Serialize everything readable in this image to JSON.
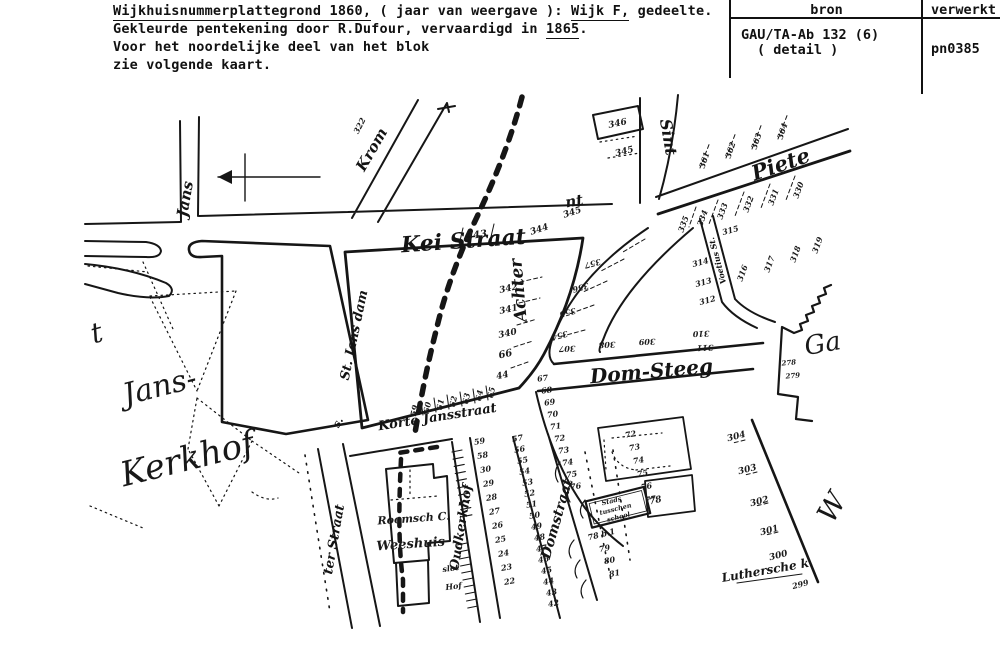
{
  "header": {
    "l1a": "Wijkhuisnummerplattegrond 1860,",
    "l1b": " ( jaar van weergave ): ",
    "l1c": "Wijk F,",
    "l1d": " gedeelte.",
    "l2a": "Gekleurde pentekening door R.Dufour, vervaardigd in ",
    "l2b": "1865",
    "l2c": ".",
    "l3": "Voor het noordelijke deel van het blok",
    "l4": "zie volgende kaart."
  },
  "table": {
    "col1_header": "bron",
    "col2_header": "verwerkt",
    "source_line1": "GAU/TA-Ab 132 (6)",
    "source_line2": "( detail )",
    "processed": "pn0385"
  },
  "map": {
    "ink": "#161616",
    "script_labels": [
      {
        "t": "t",
        "x": 99,
        "y": 342,
        "r": -15,
        "s": 28,
        "n": "script-janskerkhof-partial"
      },
      {
        "t": "Jans-",
        "x": 162,
        "y": 396,
        "r": -14,
        "s": 30,
        "n": "script-janskerkhof-jans"
      },
      {
        "t": "Kerkhof",
        "x": 190,
        "y": 470,
        "r": -14,
        "s": 34,
        "n": "script-janskerkhof-kerkhof"
      },
      {
        "t": "Ga",
        "x": 824,
        "y": 352,
        "r": -10,
        "s": 26,
        "n": "script-partial-right"
      },
      {
        "t": "W",
        "x": 840,
        "y": 512,
        "r": -60,
        "s": 28,
        "n": "script-partial-right-lower"
      }
    ],
    "street_labels": [
      {
        "t": "Jans",
        "x": 190,
        "y": 200,
        "r": -80,
        "s": 15,
        "n": "street-label-jans"
      },
      {
        "t": "Krom",
        "x": 376,
        "y": 152,
        "r": -60,
        "s": 15,
        "n": "street-label-krom"
      },
      {
        "t": "Kei Straat",
        "x": 464,
        "y": 248,
        "r": -4,
        "s": 22,
        "n": "street-label-kei-straat"
      },
      {
        "t": "St. Jans dam",
        "x": 358,
        "y": 336,
        "r": -78,
        "s": 13,
        "n": "street-label-st-jans-dam"
      },
      {
        "t": "Sint",
        "x": 663,
        "y": 138,
        "r": 80,
        "s": 16,
        "n": "street-label-sint-north"
      },
      {
        "t": "nt",
        "x": 575,
        "y": 206,
        "r": -10,
        "s": 15,
        "n": "street-label-sint-diagonal"
      },
      {
        "t": "Piete",
        "x": 783,
        "y": 171,
        "r": -19,
        "s": 21,
        "n": "street-label-pieter"
      },
      {
        "t": "Achter",
        "x": 524,
        "y": 290,
        "r": -95,
        "s": 17,
        "n": "street-label-achter"
      },
      {
        "t": "Dom-Steeg",
        "x": 652,
        "y": 378,
        "r": -5,
        "s": 20,
        "n": "street-label-dom-steeg"
      },
      {
        "t": "Voetius St.",
        "x": 720,
        "y": 260,
        "r": -105,
        "s": 8,
        "n": "street-label-voetius-steeg"
      },
      {
        "t": "Korte Jansstraat",
        "x": 438,
        "y": 421,
        "r": -9,
        "s": 13,
        "n": "street-label-korte-jansstraat"
      },
      {
        "t": "ter Straat",
        "x": 338,
        "y": 540,
        "r": -80,
        "s": 13,
        "n": "street-label-ter-straat"
      },
      {
        "t": "Oudkerkhof",
        "x": 465,
        "y": 528,
        "r": -81,
        "s": 13,
        "n": "street-label-oudkerkhof"
      },
      {
        "t": "Domstraat",
        "x": 561,
        "y": 520,
        "r": -74,
        "s": 14,
        "n": "street-label-domstraat"
      },
      {
        "t": "Luthersche k.",
        "x": 768,
        "y": 574,
        "r": -10,
        "s": 12,
        "n": "street-label-luthersche-kerk"
      },
      {
        "t": "s.",
        "x": 341,
        "y": 424,
        "r": -60,
        "s": 11,
        "n": "street-label-fragment"
      }
    ],
    "building_labels": [
      {
        "t": "Roomsch C.",
        "x": 414,
        "y": 522,
        "r": -4,
        "s": 11,
        "n": "building-label-roomsch-c"
      },
      {
        "t": "Weeshuis",
        "x": 411,
        "y": 548,
        "r": -4,
        "s": 13,
        "n": "building-label-weeshuis"
      },
      {
        "t": "Stads",
        "x": 612,
        "y": 503,
        "r": -14,
        "s": 6.5,
        "n": "building-label-stads"
      },
      {
        "t": "tusschen",
        "x": 616,
        "y": 511,
        "r": -14,
        "s": 6.5,
        "n": "building-label-tusschen"
      },
      {
        "t": "school",
        "x": 619,
        "y": 519,
        "r": -14,
        "s": 6.5,
        "n": "building-label-school"
      },
      {
        "t": "slot",
        "x": 451,
        "y": 571,
        "r": -8,
        "s": 8,
        "n": "building-label-slot"
      },
      {
        "t": "Hof",
        "x": 454,
        "y": 589,
        "r": -8,
        "s": 8,
        "n": "building-label-hof"
      },
      {
        "t": "78 b.1",
        "x": 602,
        "y": 537,
        "r": -14,
        "s": 8,
        "n": "building-label-78b1"
      }
    ],
    "numbers": [
      {
        "t": "322",
        "x": 362,
        "y": 127,
        "r": -62,
        "s": 8
      },
      {
        "t": "343",
        "x": 477,
        "y": 238,
        "r": -8,
        "s": 10
      },
      {
        "t": "344",
        "x": 540,
        "y": 232,
        "r": -18,
        "s": 9
      },
      {
        "t": "345",
        "x": 573,
        "y": 215,
        "r": -18,
        "s": 9
      },
      {
        "t": "345",
        "x": 625,
        "y": 154,
        "r": -14,
        "s": 9
      },
      {
        "t": "346",
        "x": 618,
        "y": 126,
        "r": -12,
        "s": 9
      },
      {
        "t": "342",
        "x": 509,
        "y": 291,
        "r": -12,
        "s": 9
      },
      {
        "t": "341",
        "x": 509,
        "y": 312,
        "r": -12,
        "s": 9
      },
      {
        "t": "340",
        "x": 508,
        "y": 336,
        "r": -12,
        "s": 9
      },
      {
        "t": "66",
        "x": 506,
        "y": 357,
        "r": -12,
        "s": 10
      },
      {
        "t": "44",
        "x": 503,
        "y": 378,
        "r": -12,
        "s": 9
      },
      {
        "t": "59",
        "x": 417,
        "y": 411,
        "r": -78,
        "s": 8
      },
      {
        "t": "60",
        "x": 430,
        "y": 408,
        "r": -78,
        "s": 8
      },
      {
        "t": "61",
        "x": 443,
        "y": 405,
        "r": -78,
        "s": 8
      },
      {
        "t": "62",
        "x": 456,
        "y": 402,
        "r": -78,
        "s": 8
      },
      {
        "t": "63",
        "x": 469,
        "y": 399,
        "r": -78,
        "s": 8
      },
      {
        "t": "64",
        "x": 482,
        "y": 396,
        "r": -78,
        "s": 8
      },
      {
        "t": "65",
        "x": 494,
        "y": 393,
        "r": -78,
        "s": 8
      },
      {
        "t": "361",
        "x": 707,
        "y": 161,
        "r": -72,
        "s": 8
      },
      {
        "t": "362",
        "x": 733,
        "y": 151,
        "r": -72,
        "s": 8
      },
      {
        "t": "363",
        "x": 759,
        "y": 142,
        "r": -72,
        "s": 8
      },
      {
        "t": "364",
        "x": 785,
        "y": 132,
        "r": -72,
        "s": 8
      },
      {
        "t": "330",
        "x": 801,
        "y": 191,
        "r": -70,
        "s": 8
      },
      {
        "t": "331",
        "x": 776,
        "y": 198,
        "r": -70,
        "s": 8
      },
      {
        "t": "332",
        "x": 751,
        "y": 205,
        "r": -70,
        "s": 8
      },
      {
        "t": "333",
        "x": 725,
        "y": 212,
        "r": -70,
        "s": 8
      },
      {
        "t": "334",
        "x": 705,
        "y": 219,
        "r": -70,
        "s": 8
      },
      {
        "t": "335",
        "x": 686,
        "y": 225,
        "r": -70,
        "s": 8
      },
      {
        "t": "315",
        "x": 731,
        "y": 233,
        "r": -15,
        "s": 8
      },
      {
        "t": "314",
        "x": 701,
        "y": 265,
        "r": -15,
        "s": 8
      },
      {
        "t": "313",
        "x": 704,
        "y": 285,
        "r": -15,
        "s": 8
      },
      {
        "t": "312",
        "x": 708,
        "y": 303,
        "r": -15,
        "s": 8
      },
      {
        "t": "316",
        "x": 745,
        "y": 274,
        "r": -70,
        "s": 8
      },
      {
        "t": "317",
        "x": 772,
        "y": 265,
        "r": -70,
        "s": 8
      },
      {
        "t": "318",
        "x": 798,
        "y": 255,
        "r": -70,
        "s": 8
      },
      {
        "t": "319",
        "x": 820,
        "y": 246,
        "r": -70,
        "s": 8
      },
      {
        "t": "357",
        "x": 592,
        "y": 261,
        "r": 165,
        "s": 8
      },
      {
        "t": "356",
        "x": 580,
        "y": 285,
        "r": 165,
        "s": 8
      },
      {
        "t": "355",
        "x": 567,
        "y": 310,
        "r": 165,
        "s": 8
      },
      {
        "t": "354",
        "x": 559,
        "y": 333,
        "r": 165,
        "s": 8
      },
      {
        "t": "307",
        "x": 567,
        "y": 346,
        "r": 178,
        "s": 8
      },
      {
        "t": "308",
        "x": 607,
        "y": 342,
        "r": 178,
        "s": 8
      },
      {
        "t": "309",
        "x": 647,
        "y": 339,
        "r": 178,
        "s": 8
      },
      {
        "t": "310",
        "x": 701,
        "y": 331,
        "r": 178,
        "s": 8
      },
      {
        "t": "311",
        "x": 705,
        "y": 345,
        "r": 178,
        "s": 8
      },
      {
        "t": "67",
        "x": 543,
        "y": 381,
        "r": -8,
        "s": 8
      },
      {
        "t": "68",
        "x": 547,
        "y": 393,
        "r": -8,
        "s": 8
      },
      {
        "t": "69",
        "x": 550,
        "y": 405,
        "r": -8,
        "s": 8
      },
      {
        "t": "70",
        "x": 553,
        "y": 417,
        "r": -8,
        "s": 8
      },
      {
        "t": "71",
        "x": 556,
        "y": 429,
        "r": -8,
        "s": 8
      },
      {
        "t": "72",
        "x": 560,
        "y": 441,
        "r": -8,
        "s": 8
      },
      {
        "t": "73",
        "x": 564,
        "y": 453,
        "r": -8,
        "s": 8
      },
      {
        "t": "74",
        "x": 568,
        "y": 465,
        "r": -8,
        "s": 8
      },
      {
        "t": "75",
        "x": 572,
        "y": 477,
        "r": -8,
        "s": 8
      },
      {
        "t": "76",
        "x": 576,
        "y": 489,
        "r": -8,
        "s": 8
      },
      {
        "t": "304",
        "x": 737,
        "y": 439,
        "r": -15,
        "s": 9
      },
      {
        "t": "303",
        "x": 748,
        "y": 472,
        "r": -15,
        "s": 9
      },
      {
        "t": "302",
        "x": 760,
        "y": 504,
        "r": -15,
        "s": 9
      },
      {
        "t": "301",
        "x": 770,
        "y": 533,
        "r": -15,
        "s": 9
      },
      {
        "t": "300",
        "x": 779,
        "y": 558,
        "r": -15,
        "s": 9
      },
      {
        "t": "299",
        "x": 801,
        "y": 587,
        "r": -15,
        "s": 8
      },
      {
        "t": "278",
        "x": 789,
        "y": 365,
        "r": -5,
        "s": 7
      },
      {
        "t": "279",
        "x": 793,
        "y": 378,
        "r": -5,
        "s": 7
      },
      {
        "t": "59",
        "x": 480,
        "y": 444,
        "r": -10,
        "s": 8
      },
      {
        "t": "58",
        "x": 483,
        "y": 458,
        "r": -10,
        "s": 8
      },
      {
        "t": "30",
        "x": 486,
        "y": 472,
        "r": -10,
        "s": 8
      },
      {
        "t": "29",
        "x": 489,
        "y": 486,
        "r": -10,
        "s": 8
      },
      {
        "t": "28",
        "x": 492,
        "y": 500,
        "r": -10,
        "s": 8
      },
      {
        "t": "27",
        "x": 495,
        "y": 514,
        "r": -10,
        "s": 8
      },
      {
        "t": "26",
        "x": 498,
        "y": 528,
        "r": -10,
        "s": 8
      },
      {
        "t": "25",
        "x": 501,
        "y": 542,
        "r": -10,
        "s": 8
      },
      {
        "t": "24",
        "x": 504,
        "y": 556,
        "r": -10,
        "s": 8
      },
      {
        "t": "23",
        "x": 507,
        "y": 570,
        "r": -10,
        "s": 8
      },
      {
        "t": "22",
        "x": 510,
        "y": 584,
        "r": -10,
        "s": 8
      },
      {
        "t": "57",
        "x": 518,
        "y": 441,
        "r": -10,
        "s": 8
      },
      {
        "t": "56",
        "x": 520,
        "y": 452,
        "r": -10,
        "s": 8
      },
      {
        "t": "55",
        "x": 523,
        "y": 463,
        "r": -10,
        "s": 8
      },
      {
        "t": "54",
        "x": 525,
        "y": 474,
        "r": -10,
        "s": 8
      },
      {
        "t": "53",
        "x": 528,
        "y": 485,
        "r": -10,
        "s": 8
      },
      {
        "t": "52",
        "x": 530,
        "y": 496,
        "r": -10,
        "s": 8
      },
      {
        "t": "51",
        "x": 532,
        "y": 507,
        "r": -10,
        "s": 8
      },
      {
        "t": "50",
        "x": 535,
        "y": 518,
        "r": -10,
        "s": 8
      },
      {
        "t": "49",
        "x": 537,
        "y": 529,
        "r": -10,
        "s": 8
      },
      {
        "t": "48",
        "x": 540,
        "y": 540,
        "r": -10,
        "s": 8
      },
      {
        "t": "47",
        "x": 542,
        "y": 551,
        "r": -10,
        "s": 8
      },
      {
        "t": "46",
        "x": 544,
        "y": 562,
        "r": -10,
        "s": 8
      },
      {
        "t": "45",
        "x": 547,
        "y": 573,
        "r": -10,
        "s": 8
      },
      {
        "t": "44",
        "x": 549,
        "y": 584,
        "r": -10,
        "s": 8
      },
      {
        "t": "43",
        "x": 552,
        "y": 595,
        "r": -10,
        "s": 8
      },
      {
        "t": "42",
        "x": 554,
        "y": 606,
        "r": -10,
        "s": 8
      },
      {
        "t": "72",
        "x": 631,
        "y": 437,
        "r": -10,
        "s": 8
      },
      {
        "t": "73",
        "x": 635,
        "y": 450,
        "r": -10,
        "s": 8
      },
      {
        "t": "74",
        "x": 639,
        "y": 463,
        "r": -10,
        "s": 8
      },
      {
        "t": "75",
        "x": 643,
        "y": 476,
        "r": -10,
        "s": 8
      },
      {
        "t": "76",
        "x": 647,
        "y": 489,
        "r": -10,
        "s": 8
      },
      {
        "t": "77",
        "x": 651,
        "y": 502,
        "r": -10,
        "s": 8
      },
      {
        "t": "78",
        "x": 656,
        "y": 503,
        "r": -14,
        "s": 9
      },
      {
        "t": "79",
        "x": 605,
        "y": 551,
        "r": -10,
        "s": 8
      },
      {
        "t": "80",
        "x": 610,
        "y": 563,
        "r": -10,
        "s": 8
      },
      {
        "t": "81",
        "x": 615,
        "y": 576,
        "r": -10,
        "s": 8
      }
    ]
  }
}
